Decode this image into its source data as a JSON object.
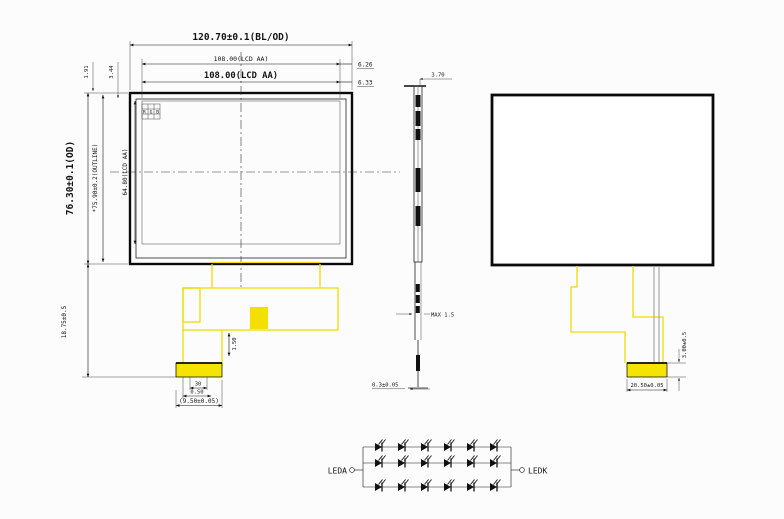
{
  "front_view": {
    "dim_width_od": "120.70±0.1(BL/OD)",
    "dim_width_aa_ref": "108.00(LCD AA)",
    "dim_width_aa": "108.00(LCD AA)",
    "dim_offset_right_top": "6.26",
    "dim_offset_right_bottom": "6.33",
    "dim_height_od": "76.30±0.1(OD)",
    "dim_height_outline": "*75.90±0.2(OUTLINE)",
    "dim_height_aa": "64.80(LCD AA)",
    "dim_top_offset_a": "1.91",
    "dim_top_offset_b": "3.44",
    "dim_fpc_drop": "18.75±0.5",
    "pixel_mark": "RGB",
    "fpc": {
      "dim_tail_length": "1.50",
      "dim_pin_count": "30",
      "dim_pin_pitch": "0.50",
      "dim_connector_width": "(9.50±0.05)"
    }
  },
  "side_view": {
    "dim_thickness": "3.70",
    "dim_fpc_max_thickness": "MAX 1.5",
    "dim_tail_thickness": "0.3±0.05"
  },
  "back_view": {
    "dim_connector_width": "20.50±0.05",
    "dim_connector_offset": "3.00±0.5"
  },
  "led_circuit": {
    "anode_label": "LEDA",
    "cathode_label": "LEDK",
    "rows": 3,
    "leds_per_row": 6
  },
  "colors": {
    "line": "#141414",
    "fpc_yellow": "#efdc00",
    "background": "#fcfcfc"
  }
}
